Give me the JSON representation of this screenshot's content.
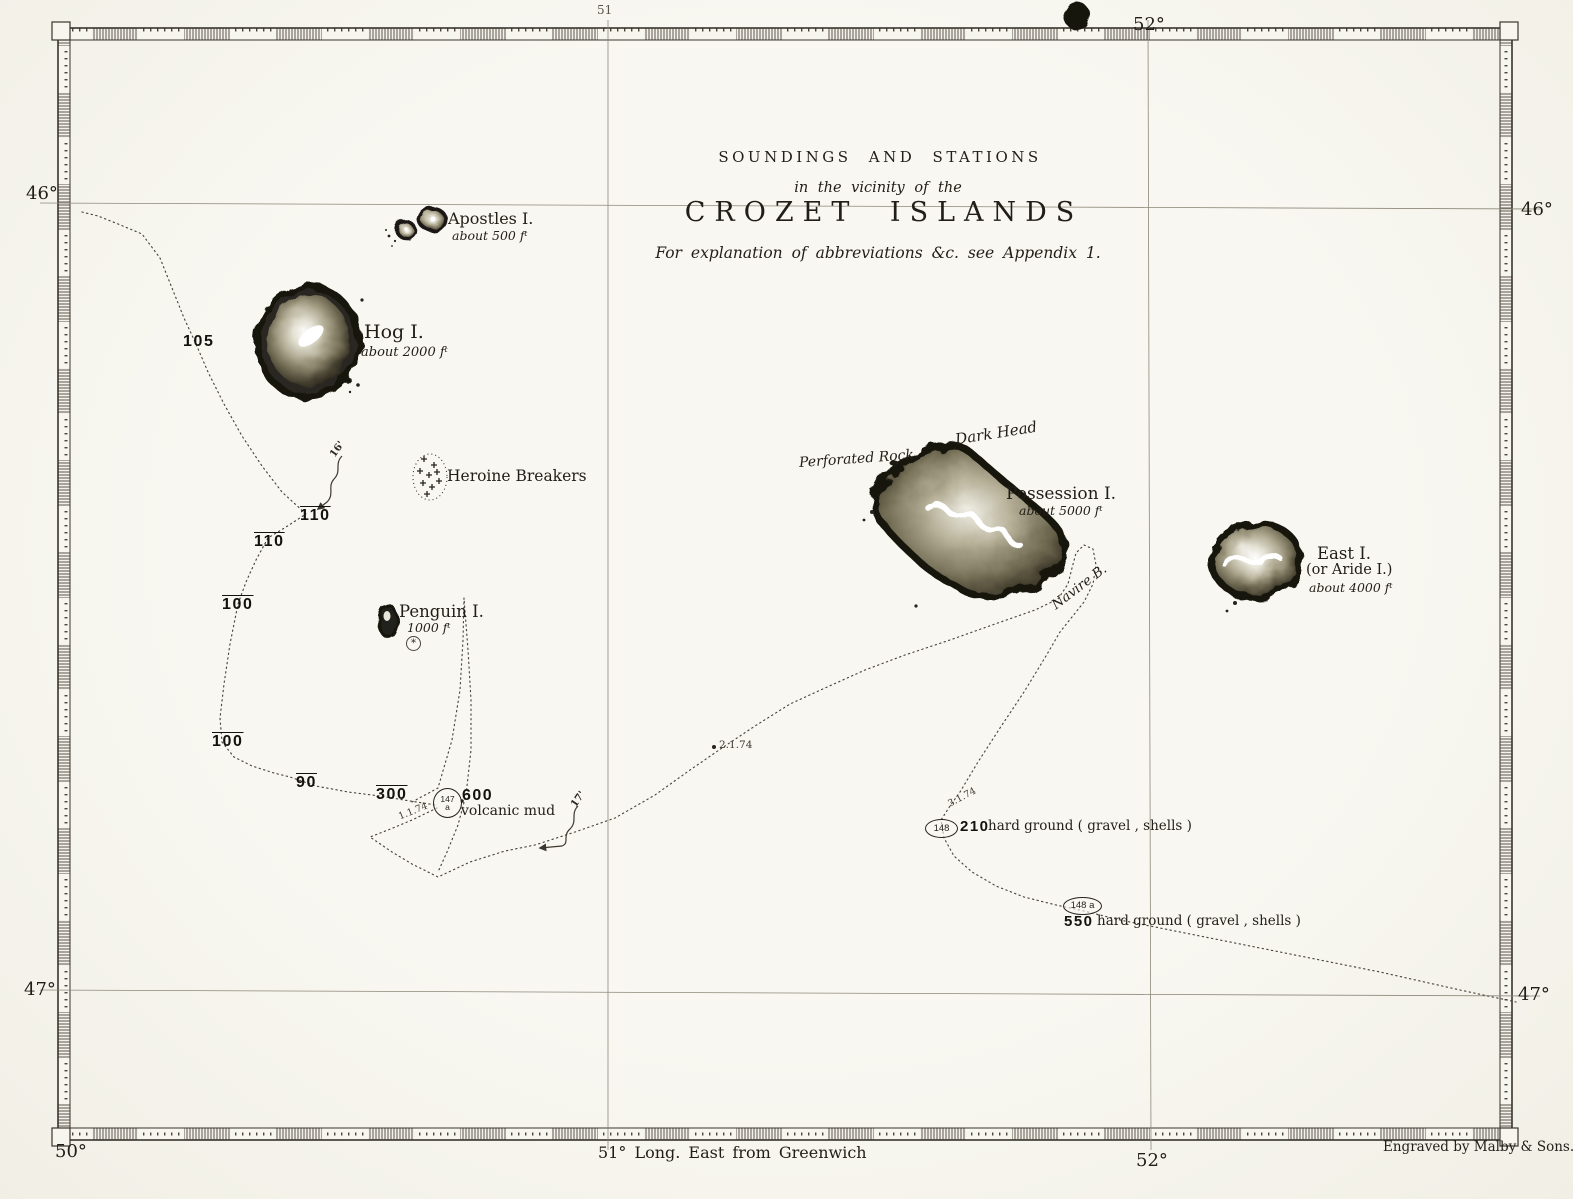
{
  "title": {
    "line1": "SOUNDINGS  AND  STATIONS",
    "line2": "in the vicinity of the",
    "line3": "CROZET  ISLANDS",
    "line4": "For explanation of abbreviations &c. see Appendix 1."
  },
  "graticule": {
    "lat_left_46": "46°",
    "lat_left_47": "47°",
    "lat_right_46": "46°",
    "lat_right_47": "47°",
    "lon_top_51_partial": "51",
    "lon_top_52": "52°",
    "lon_bottom_50": "50°",
    "lon_bottom_51": "51° Long. East from Greenwich",
    "lon_bottom_52": "52°"
  },
  "islands": {
    "apostles": {
      "name": "Apostles I.",
      "elev": "about 500 fᵗ"
    },
    "hog": {
      "name": "Hog I.",
      "elev": "about 2000 fᵗ"
    },
    "penguin": {
      "name": "Penguin I.",
      "elev": "1000 fᵗ"
    },
    "possession": {
      "name": "Possession I.",
      "elev": "about 5000 fᵗ"
    },
    "east": {
      "name": "East I.",
      "alt": "(or Aride I.)",
      "elev": "about 4000 fᵗ"
    }
  },
  "features": {
    "heroine_breakers": "Heroine Breakers",
    "dark_head": "Dark Head",
    "perforated_rock": "Perforated Rock",
    "navire_bay": "Navire B.",
    "penguin_spot": "*"
  },
  "soundings": {
    "s105": "105",
    "s110a": "110",
    "s110b": "110",
    "s100a": "100",
    "s100b": "100",
    "s90": "90",
    "s300": "300"
  },
  "stations": {
    "st147": {
      "id": "147",
      "sub": "a",
      "depth": "600",
      "bottom": "volcanic mud",
      "date": "1.1.74"
    },
    "st148": {
      "id": "148",
      "depth": "210",
      "bottom": "hard ground ( gravel ,  shells )",
      "date": "3.1.74"
    },
    "st148a": {
      "id": "148 a",
      "depth": "550",
      "bottom": "hard ground ( gravel ,  shells )"
    }
  },
  "track": {
    "date2": "2.1.74",
    "current16": "16'",
    "current17": "17'"
  },
  "credit": "Engraved by Malby & Sons."
}
